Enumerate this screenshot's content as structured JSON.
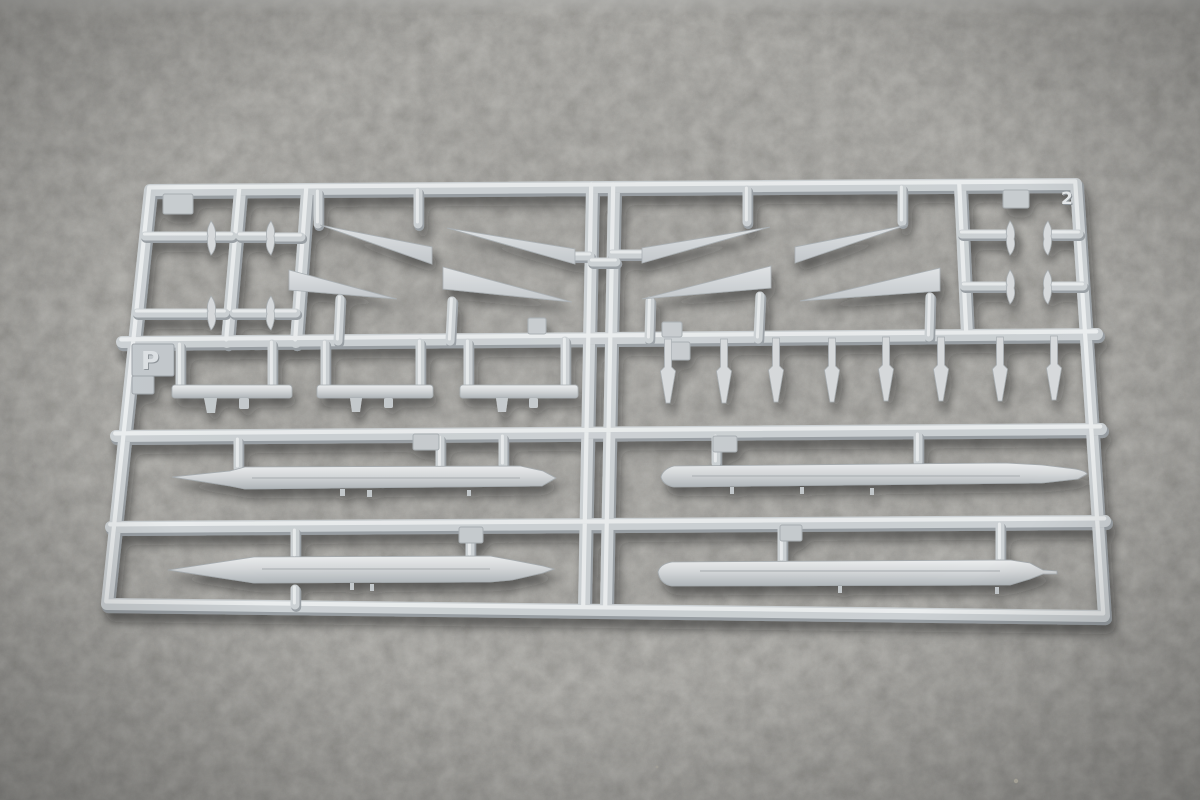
{
  "photo": {
    "subject": "Light-gray injection-molded model kit sprue (runner frame) holding missile parts, photographed on dark gray felt",
    "sprue_letter": "P",
    "mold_number": "2",
    "plastic_color": "#ccd1d4",
    "felt_color": "#53514c",
    "part_counts": {
      "delta_wings": 8,
      "missile_bodies": 4,
      "dart_fins": 8,
      "pylon_rails": 3,
      "small_fins": 8
    }
  }
}
